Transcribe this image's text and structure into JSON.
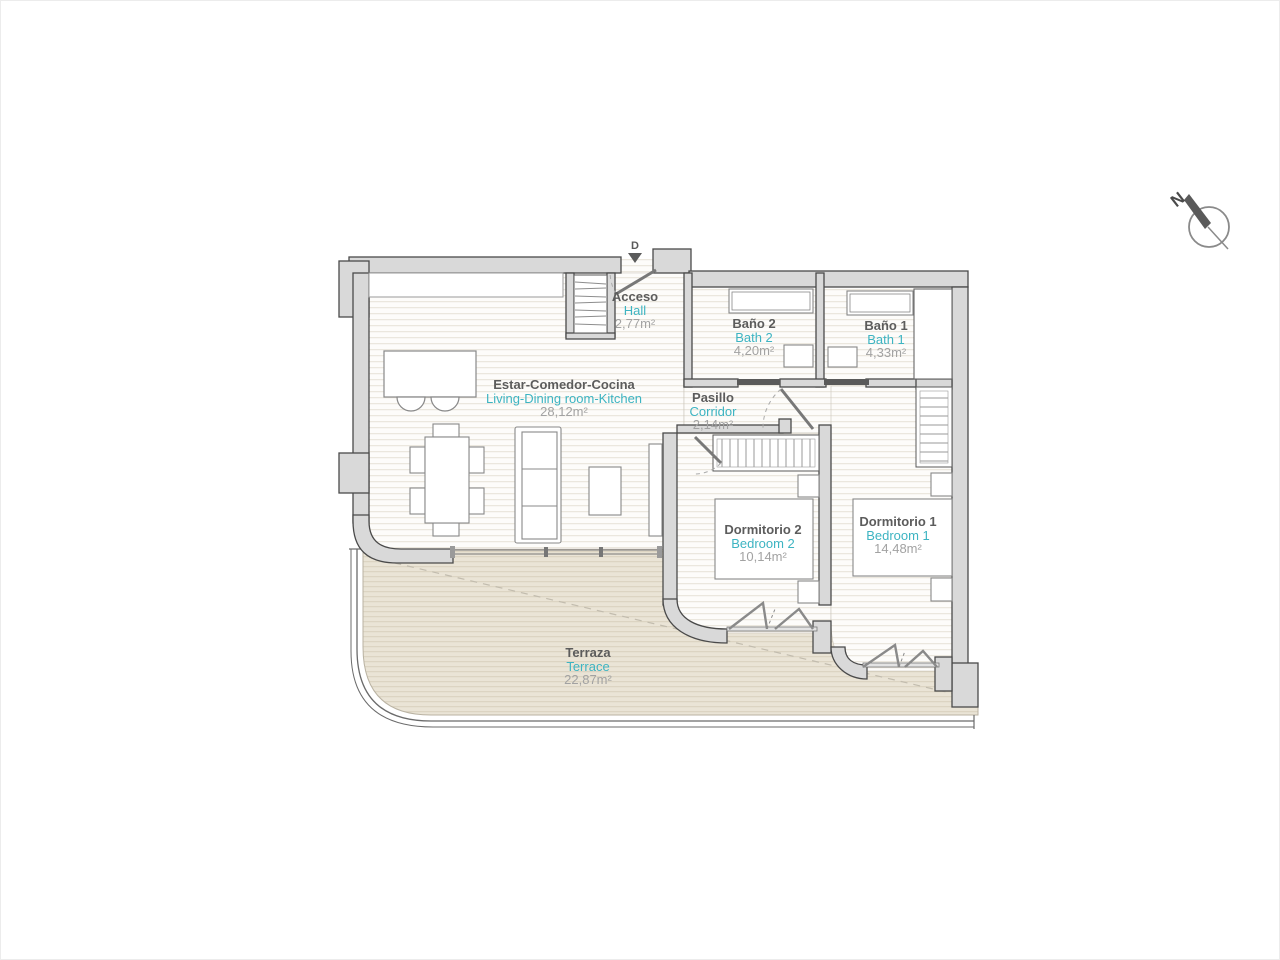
{
  "plan": {
    "compass": {
      "north_label": "N"
    },
    "entrance_marker": "D",
    "rooms": {
      "hall": {
        "name_es": "Acceso",
        "name_en": "Hall",
        "area": "2,77m²"
      },
      "living": {
        "name_es": "Estar-Comedor-Cocina",
        "name_en": "Living-Dining room-Kitchen",
        "area": "28,12m²"
      },
      "bath2": {
        "name_es": "Baño 2",
        "name_en": "Bath 2",
        "area": "4,20m²"
      },
      "bath1": {
        "name_es": "Baño 1",
        "name_en": "Bath 1",
        "area": "4,33m²"
      },
      "corridor": {
        "name_es": "Pasillo",
        "name_en": "Corridor",
        "area": "2,14m²"
      },
      "bedroom2": {
        "name_es": "Dormitorio 2",
        "name_en": "Bedroom 2",
        "area": "10,14m²"
      },
      "bedroom1": {
        "name_es": "Dormitorio 1",
        "name_en": "Bedroom 1",
        "area": "14,48m²"
      },
      "terrace": {
        "name_es": "Terraza",
        "name_en": "Terrace",
        "area": "22,87m²"
      }
    },
    "colors": {
      "accent_en": "#3db4c2",
      "label_es": "#5c5c5c",
      "area_text": "#a2a2a2",
      "wall_fill": "#d9d9d9",
      "wall_stroke": "#4a4a4a",
      "terrace_fill": "#eae4d6"
    }
  }
}
